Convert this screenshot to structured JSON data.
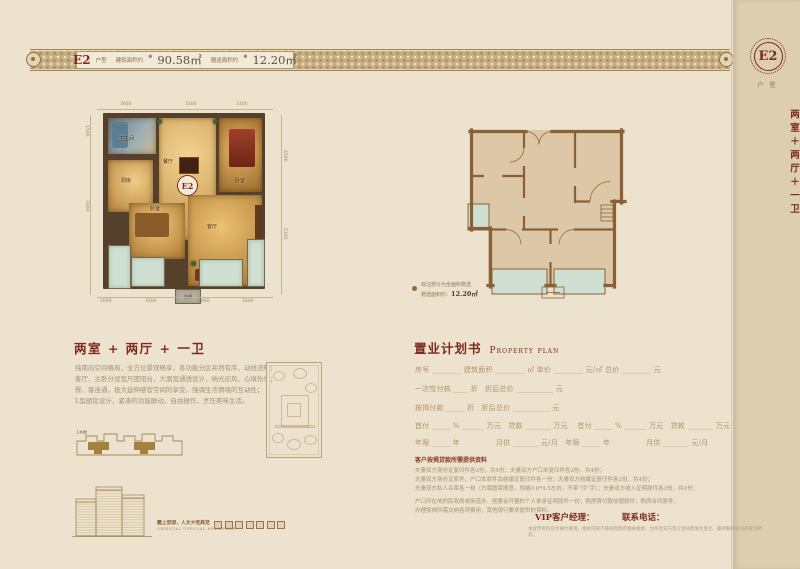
{
  "top_band": {
    "unit": "E2",
    "unit_suffix": "户型",
    "marker": "❋",
    "area1_label": "建筑面积约",
    "area1_value": "90.58㎡",
    "area2_label": "赠送面积约",
    "area2_value": "12.20㎡"
  },
  "side_band": {
    "unit": "E2",
    "label": "户型",
    "layout": "两室＋两厅＋一卫"
  },
  "left_plan": {
    "dims_top": [
      "3600",
      "3500",
      "3100"
    ],
    "dims_bottom": [
      "1600",
      "3200",
      "3800",
      "1600"
    ],
    "dims_left": [
      "1500",
      "3000"
    ],
    "dims_right": [
      "4500",
      "5100"
    ],
    "rooms": {
      "bath": "卫生间",
      "kitchen": "厨房",
      "dining": "餐厅",
      "master": "卧室",
      "bedroom": "卧室",
      "living": "客厅"
    },
    "badge": "E2",
    "ac": "空调"
  },
  "right_plan": {
    "note_line1": "标注部分为全面积赠送",
    "note_line2_label": "赠送面积约：",
    "note_line2_value": "12.20㎡"
  },
  "desc": {
    "title": "两室 + 两厅 + 一卫",
    "lines": [
      "纯南向空间格局，全方位景观畅享，各功能分区井然有序，动线流畅；",
      "客厅、主卧分设宽尺度阳台，大面宽通透设计，纳光迎风，心境怡然；",
      "餐、客连通，极大延伸感官空间的享受，强调生活情境的互动性；",
      "L型厨房设计，紧凑的功能联动，自由操作，烹饪美味生活。"
    ]
  },
  "property_plan": {
    "title_cn": "置业计划书",
    "title_en": "Property plan",
    "rows": [
      "房号 ________  建筑面积 ________ ㎡  单价 ________ 元/㎡  总价 ________ 元",
      "一次性付款 ____ 折　折后总价 __________ 元",
      "按揭付款 _____ 折　折后总价 __________ 元",
      "首付 _____ % ______ 万元　贷款 _______ 万元　 首付 _____ % ______ 万元　贷款 _______ 万元",
      "年限 _____ 年　　　　　月供 _______ 元/月　年限 _____ 年　　　　　月供 _______ 元/月"
    ]
  },
  "docs": {
    "header": "客户按揭贷款所需提供资料",
    "lines": [
      "夫妻双方身份证复印件各2份，共4份；夫妻双方户口本复印件各2份，共4份；",
      "夫妻双方身份证原件，户口本原件及结婚证复印件各一份；夫妻双方结婚证复印件各2份，共4份；",
      "夫妻双方私人名章各一枚（方章圆章随意，规格0.8*4.5左右，不带“印”字）；夫妻双方收入证明原件各2份，共4份；"
    ],
    "extra": [
      "户口所在地的民政局或街道办、居委会开据的个人单身证明原件一份；购房首付款收据原件；购房合同原件；",
      "办理按揭所需交纳各项费用，其他银行要求提供的资料。"
    ]
  },
  "contacts": {
    "vip_label": "VIP客户经理：",
    "phone_label": "联系电话：",
    "disclaimer": "本宣传资料仅为要约邀请，相关内容不排除因政府相关规划、文件及双方签订合同而发生变化，最终解释权归开发商所有。"
  },
  "footer_left": {
    "plate_label": "1#楼",
    "tagline": "麓上官邸，人文大宅典范",
    "tagline_sub": "ORIENTAL OFFICIAL RESIDENCE"
  }
}
